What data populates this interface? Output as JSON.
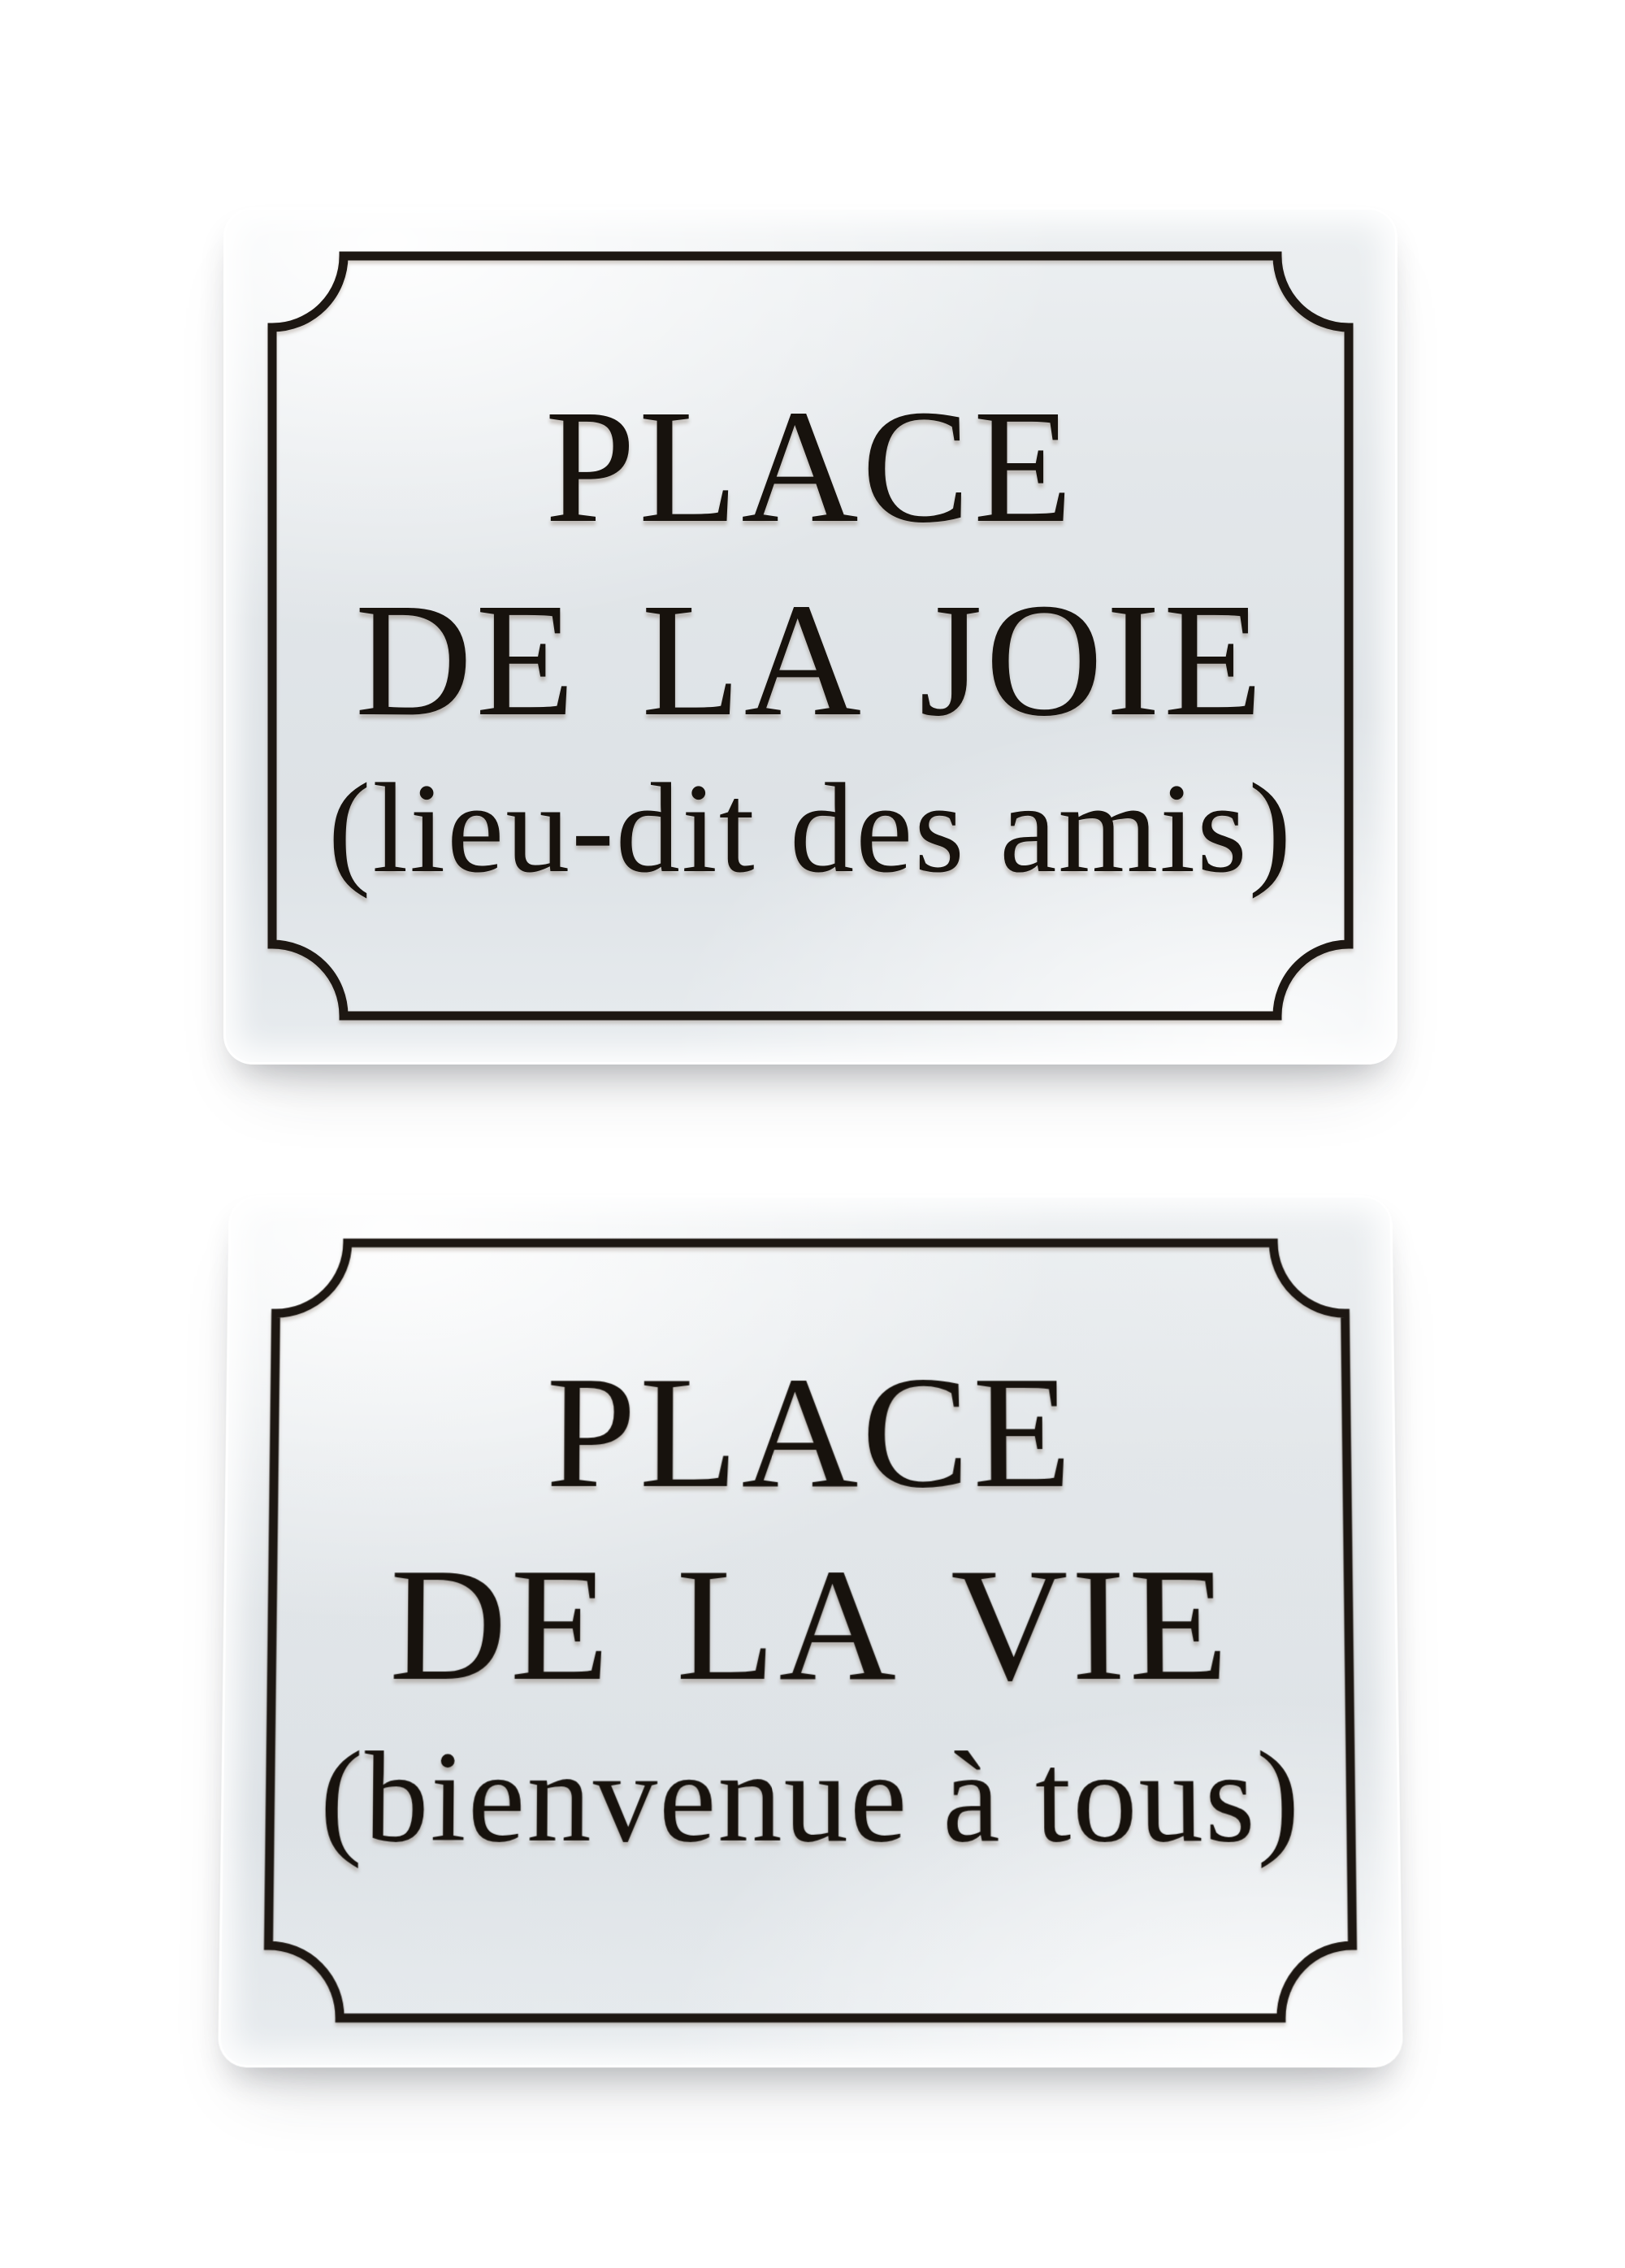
{
  "scene": {
    "background_color": "#ffffff",
    "plaque_face_color": "#e3e7ea",
    "plaque_edge_highlight": "#ffffff",
    "border_ink_color": "#1d1712",
    "text_ink_color": "#17120d"
  },
  "plaques": [
    {
      "id": "place-de-la-joie",
      "line1": "PLACE",
      "line2": "DE LA JOIE",
      "subtitle": "(lieu-dit des amis)"
    },
    {
      "id": "place-de-la-vie",
      "line1": "PLACE",
      "line2": "DE LA VIE",
      "subtitle": "(bienvenue à tous)"
    }
  ]
}
